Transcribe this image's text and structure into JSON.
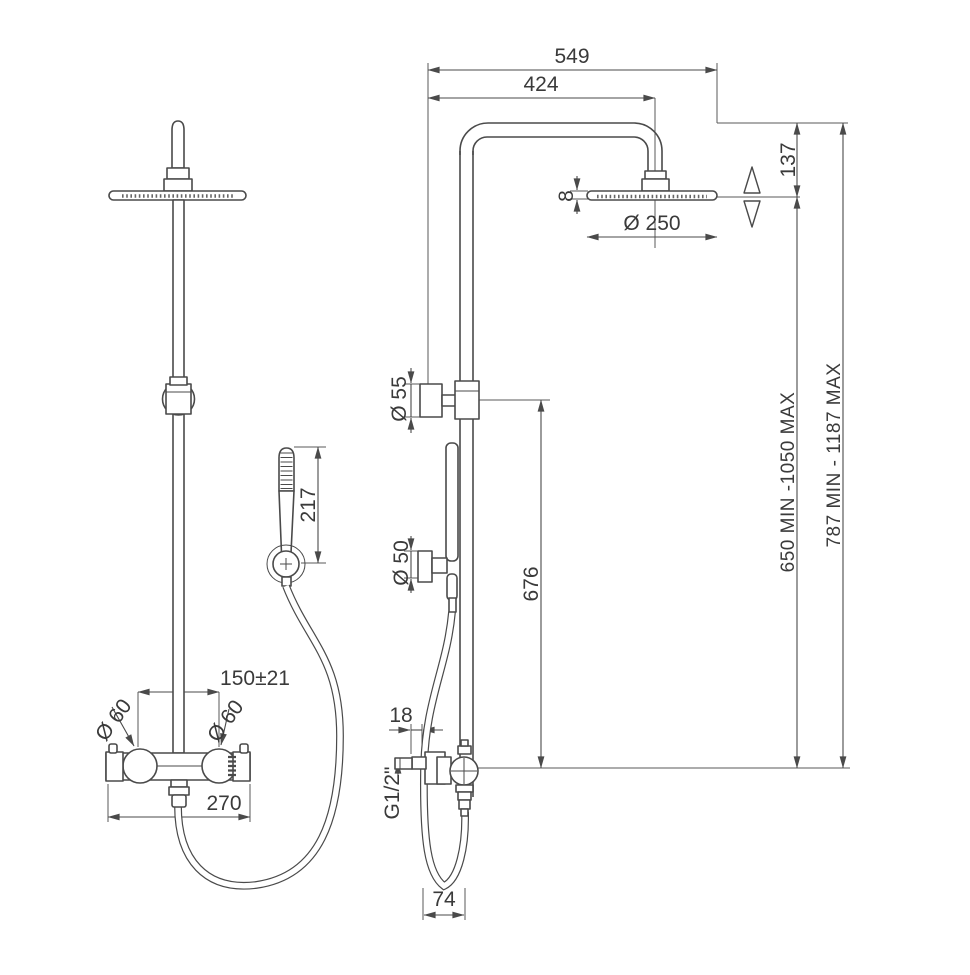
{
  "page": {
    "background": "#ffffff",
    "description": "Technical dimensional drawing of a thermostatic shower column, front and side views"
  },
  "drawing": {
    "line_color": "#4a4a4a",
    "text_color": "#3a3a3a",
    "dims": {
      "total_width": "549",
      "arm_projection": "424",
      "head_drop": "137",
      "head_thickness": "8",
      "head_diameter": "Ø 250",
      "upper_bracket_dia": "Ø 55",
      "lower_bracket_dia": "Ø 50",
      "handshower_length": "217",
      "bracket_to_valve": "676",
      "column_range": "650 MIN -1050 MAX",
      "overall_range": "787 MIN - 1187 MAX",
      "inlet_spacing": "150±21",
      "inlet_dia_left": "Ø 60",
      "inlet_dia_right": "Ø 60",
      "valve_width": "270",
      "wall_offset": "18",
      "thread_size": "G1/2\"",
      "hose_loop_width": "74"
    }
  }
}
